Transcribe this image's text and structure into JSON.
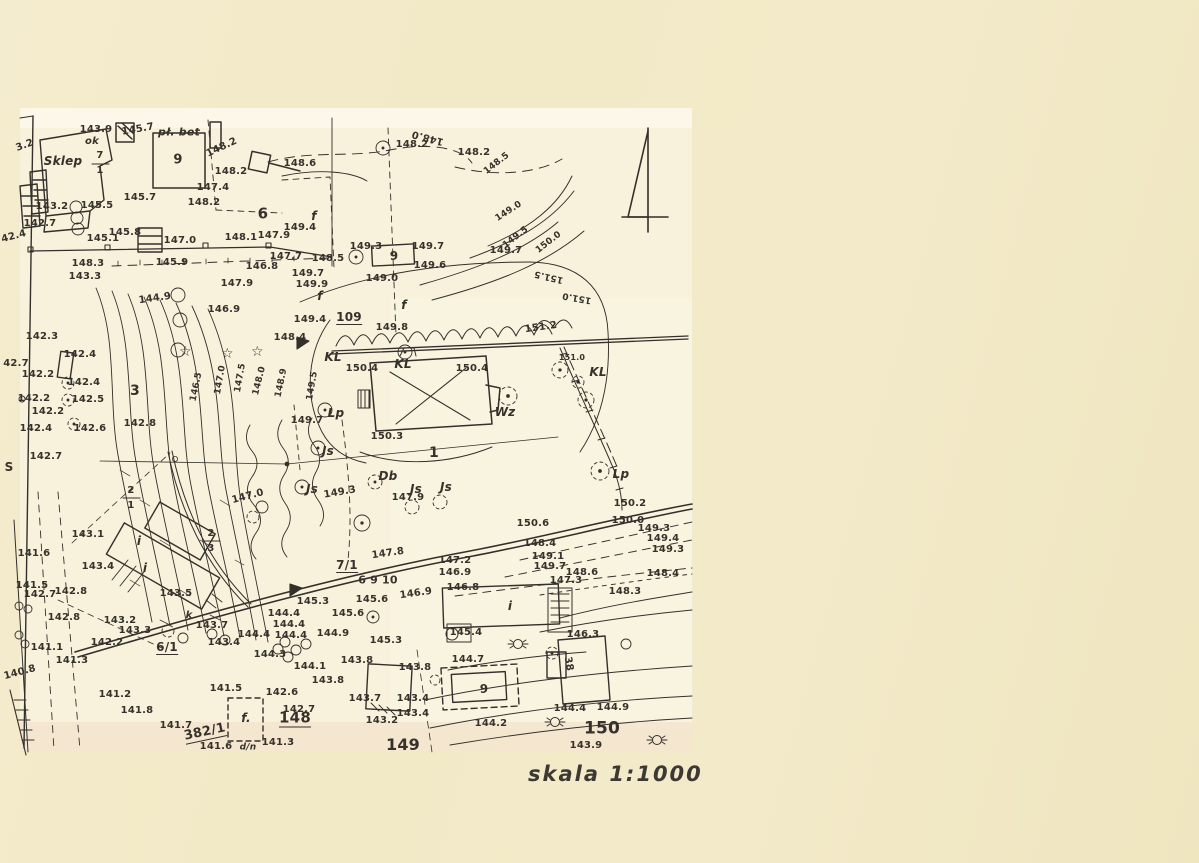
{
  "colors": {
    "paper": "#f1e8c6",
    "sheet": "#f8f1dc",
    "ink": "#33302b"
  },
  "map": {
    "scale_label": "skala 1:1000",
    "north_arrow": "north-arrow",
    "labels": [
      {
        "t": "143.9",
        "x": 96,
        "y": 130
      },
      {
        "t": "ok",
        "x": 92,
        "y": 142,
        "n": "abbrev-label",
        "i": 1
      },
      {
        "t": "pł. bet",
        "x": 179,
        "y": 132,
        "s": 11,
        "n": "surface-label",
        "i": 1
      },
      {
        "t": "Sklep",
        "x": 63,
        "y": 161,
        "s": 12,
        "n": "building-name-label",
        "i": 1
      },
      {
        "t": "7",
        "x": 100,
        "y": 156,
        "n": "parcel-label"
      },
      {
        "t": "1",
        "x": 100,
        "y": 171,
        "n": "parcel-label"
      },
      {
        "t": "9",
        "x": 178,
        "y": 160,
        "s": 13,
        "n": "building-label"
      },
      {
        "t": "3.2",
        "x": 25,
        "y": 146,
        "r": -20
      },
      {
        "t": "145.7",
        "x": 138,
        "y": 130,
        "r": -10
      },
      {
        "t": "148.2",
        "x": 222,
        "y": 148,
        "r": -25
      },
      {
        "t": "148.2",
        "x": 231,
        "y": 172
      },
      {
        "t": "147.4",
        "x": 213,
        "y": 188
      },
      {
        "t": "148.2",
        "x": 204,
        "y": 203
      },
      {
        "t": "6",
        "x": 263,
        "y": 214,
        "s": 15,
        "n": "parcel-label"
      },
      {
        "t": "145.5",
        "x": 97,
        "y": 206
      },
      {
        "t": "145.7",
        "x": 140,
        "y": 198
      },
      {
        "t": "143.2",
        "x": 52,
        "y": 207
      },
      {
        "t": "142.7",
        "x": 40,
        "y": 224
      },
      {
        "t": "145.1",
        "x": 103,
        "y": 239
      },
      {
        "t": "145.8",
        "x": 125,
        "y": 233
      },
      {
        "t": "147.0",
        "x": 180,
        "y": 241
      },
      {
        "t": "148.1",
        "x": 241,
        "y": 238
      },
      {
        "t": "145.9",
        "x": 172,
        "y": 263
      },
      {
        "t": "148.3",
        "x": 88,
        "y": 264
      },
      {
        "t": "143.3",
        "x": 85,
        "y": 277
      },
      {
        "t": "144.9",
        "x": 155,
        "y": 299,
        "r": -8
      },
      {
        "t": "147.9",
        "x": 274,
        "y": 236
      },
      {
        "t": "147.9",
        "x": 237,
        "y": 284
      },
      {
        "t": "146.9",
        "x": 224,
        "y": 310
      },
      {
        "t": "147.7",
        "x": 286,
        "y": 257
      },
      {
        "t": "146.8",
        "x": 262,
        "y": 267
      },
      {
        "t": "148.5",
        "x": 328,
        "y": 259
      },
      {
        "t": "149.4",
        "x": 300,
        "y": 228
      },
      {
        "t": "149.3",
        "x": 366,
        "y": 247
      },
      {
        "t": "9",
        "x": 394,
        "y": 256,
        "s": 12,
        "n": "building-label"
      },
      {
        "t": "149.7",
        "x": 428,
        "y": 247
      },
      {
        "t": "149.6",
        "x": 430,
        "y": 266
      },
      {
        "t": "149.0",
        "x": 382,
        "y": 279
      },
      {
        "t": "149.7",
        "x": 308,
        "y": 274
      },
      {
        "t": "149.9",
        "x": 312,
        "y": 285
      },
      {
        "t": "f",
        "x": 314,
        "y": 216,
        "s": 12,
        "i": 1,
        "n": "tree-species-label"
      },
      {
        "t": "f",
        "x": 320,
        "y": 296,
        "s": 12,
        "i": 1,
        "n": "tree-species-label"
      },
      {
        "t": "f",
        "x": 404,
        "y": 305,
        "s": 12,
        "i": 1,
        "n": "tree-species-label"
      },
      {
        "t": "149.4",
        "x": 310,
        "y": 320
      },
      {
        "t": "109",
        "x": 349,
        "y": 318,
        "s": 12,
        "u": 1,
        "n": "parcel-label"
      },
      {
        "t": "149.8",
        "x": 392,
        "y": 328
      },
      {
        "t": "148.4",
        "x": 290,
        "y": 338
      },
      {
        "t": "148.6",
        "x": 300,
        "y": 164
      },
      {
        "t": "148.0",
        "x": 428,
        "y": 137,
        "r": 195
      },
      {
        "t": "148.2",
        "x": 412,
        "y": 145
      },
      {
        "t": "148.2",
        "x": 474,
        "y": 153
      },
      {
        "t": "148.5",
        "x": 497,
        "y": 164,
        "r": -38,
        "s": 9
      },
      {
        "t": "149.0",
        "x": 509,
        "y": 212,
        "r": -33,
        "s": 9
      },
      {
        "t": "149.5",
        "x": 516,
        "y": 238,
        "r": -38,
        "s": 9
      },
      {
        "t": "150.0",
        "x": 549,
        "y": 243,
        "r": -38,
        "s": 9
      },
      {
        "t": "149.7",
        "x": 506,
        "y": 251
      },
      {
        "t": "151.5",
        "x": 549,
        "y": 276,
        "r": 193,
        "s": 9
      },
      {
        "t": "151.0",
        "x": 577,
        "y": 297,
        "r": 190,
        "s": 9
      },
      {
        "t": "151.2",
        "x": 541,
        "y": 328,
        "r": -8
      },
      {
        "t": "151.0",
        "x": 572,
        "y": 358,
        "s": 8
      },
      {
        "t": "KL",
        "x": 333,
        "y": 357,
        "s": 12,
        "i": 1,
        "n": "tree-species-label"
      },
      {
        "t": "KL",
        "x": 403,
        "y": 364,
        "s": 12,
        "i": 1,
        "n": "tree-species-label"
      },
      {
        "t": "KL",
        "x": 598,
        "y": 372,
        "s": 12,
        "i": 1,
        "n": "tree-species-label"
      },
      {
        "t": "150.4",
        "x": 362,
        "y": 369
      },
      {
        "t": "150.4",
        "x": 472,
        "y": 369
      },
      {
        "t": "Wz",
        "x": 505,
        "y": 412,
        "s": 12,
        "i": 1,
        "n": "tree-species-label"
      },
      {
        "t": "150.3",
        "x": 387,
        "y": 437
      },
      {
        "t": "1",
        "x": 434,
        "y": 453,
        "s": 14,
        "n": "building-label"
      },
      {
        "t": "Lp",
        "x": 621,
        "y": 474,
        "s": 12,
        "i": 1,
        "n": "tree-species-label"
      },
      {
        "t": "Lp",
        "x": 336,
        "y": 413,
        "s": 12,
        "i": 1,
        "n": "tree-species-label"
      },
      {
        "t": "149.7",
        "x": 307,
        "y": 421
      },
      {
        "t": "150.2",
        "x": 630,
        "y": 504
      },
      {
        "t": "150.0",
        "x": 628,
        "y": 521
      },
      {
        "t": "150.6",
        "x": 533,
        "y": 524
      },
      {
        "t": "149.3",
        "x": 654,
        "y": 529
      },
      {
        "t": "149.4",
        "x": 663,
        "y": 539
      },
      {
        "t": "149.3",
        "x": 668,
        "y": 550
      },
      {
        "t": "148.4",
        "x": 540,
        "y": 544
      },
      {
        "t": "149.1",
        "x": 548,
        "y": 557
      },
      {
        "t": "149.7",
        "x": 550,
        "y": 567
      },
      {
        "t": "148.6",
        "x": 582,
        "y": 573
      },
      {
        "t": "148.4",
        "x": 663,
        "y": 574
      },
      {
        "t": "147.3",
        "x": 566,
        "y": 581
      },
      {
        "t": "148.3",
        "x": 625,
        "y": 592
      },
      {
        "t": "146.3",
        "x": 583,
        "y": 635
      },
      {
        "t": "38",
        "x": 568,
        "y": 664,
        "r": 80,
        "n": "building-label"
      },
      {
        "t": "i",
        "x": 510,
        "y": 606,
        "s": 12,
        "i": 1,
        "n": "building-label"
      },
      {
        "t": "145.4",
        "x": 466,
        "y": 633
      },
      {
        "t": "144.7",
        "x": 468,
        "y": 660
      },
      {
        "t": "9",
        "x": 484,
        "y": 689,
        "s": 12,
        "n": "building-label"
      },
      {
        "t": "144.4",
        "x": 570,
        "y": 709
      },
      {
        "t": "144.9",
        "x": 613,
        "y": 708
      },
      {
        "t": "144.2",
        "x": 491,
        "y": 724
      },
      {
        "t": "150",
        "x": 602,
        "y": 729,
        "s": 17
      },
      {
        "t": "143.9",
        "x": 586,
        "y": 746
      },
      {
        "t": "142.3",
        "x": 42,
        "y": 337
      },
      {
        "t": "142.4",
        "x": 80,
        "y": 355
      },
      {
        "t": "42.7",
        "x": 16,
        "y": 364
      },
      {
        "t": "142.2",
        "x": 38,
        "y": 375
      },
      {
        "t": "142.4",
        "x": 84,
        "y": 383
      },
      {
        "t": "142.2",
        "x": 34,
        "y": 399
      },
      {
        "t": "142.5",
        "x": 88,
        "y": 400
      },
      {
        "t": "3",
        "x": 135,
        "y": 391,
        "s": 14,
        "n": "parcel-label"
      },
      {
        "t": "142.2",
        "x": 48,
        "y": 412
      },
      {
        "t": "142.8",
        "x": 140,
        "y": 424
      },
      {
        "t": "142.4",
        "x": 36,
        "y": 429
      },
      {
        "t": "142.6",
        "x": 90,
        "y": 429
      },
      {
        "t": "142.7",
        "x": 46,
        "y": 457
      },
      {
        "t": "42.4",
        "x": 14,
        "y": 237,
        "r": -15
      },
      {
        "t": "146.5",
        "x": 197,
        "y": 387,
        "r": -78,
        "s": 9
      },
      {
        "t": "147.0",
        "x": 221,
        "y": 380,
        "r": -80,
        "s": 9
      },
      {
        "t": "147.5",
        "x": 241,
        "y": 378,
        "r": -80,
        "s": 9
      },
      {
        "t": "148.0",
        "x": 260,
        "y": 381,
        "r": -76,
        "s": 9
      },
      {
        "t": "148.9",
        "x": 282,
        "y": 383,
        "r": -78,
        "s": 9
      },
      {
        "t": "149.5",
        "x": 313,
        "y": 386,
        "r": -80,
        "s": 9
      },
      {
        "t": "S",
        "x": 9,
        "y": 467,
        "s": 12,
        "n": "boundary-letter-label"
      },
      {
        "t": "2",
        "x": 131,
        "y": 491,
        "n": "parcel-label"
      },
      {
        "t": "1",
        "x": 131,
        "y": 506,
        "n": "parcel-label"
      },
      {
        "t": "2",
        "x": 211,
        "y": 534,
        "n": "parcel-label"
      },
      {
        "t": "3",
        "x": 211,
        "y": 549,
        "n": "parcel-label"
      },
      {
        "t": "147.0",
        "x": 248,
        "y": 497,
        "r": -15
      },
      {
        "t": "149.3",
        "x": 340,
        "y": 493,
        "r": -10
      },
      {
        "t": "147.9",
        "x": 408,
        "y": 498
      },
      {
        "t": "Js",
        "x": 312,
        "y": 489,
        "s": 12,
        "i": 1,
        "n": "tree-species-label"
      },
      {
        "t": "Js",
        "x": 328,
        "y": 451,
        "s": 12,
        "i": 1,
        "n": "tree-species-label"
      },
      {
        "t": "Db",
        "x": 388,
        "y": 476,
        "s": 12,
        "i": 1,
        "n": "tree-species-label"
      },
      {
        "t": "Js",
        "x": 416,
        "y": 489,
        "s": 12,
        "i": 1,
        "n": "tree-species-label"
      },
      {
        "t": "Js",
        "x": 446,
        "y": 487,
        "s": 12,
        "i": 1,
        "n": "tree-species-label"
      },
      {
        "t": "143.1",
        "x": 88,
        "y": 535
      },
      {
        "t": "143.4",
        "x": 98,
        "y": 567
      },
      {
        "t": "i",
        "x": 139,
        "y": 541,
        "s": 12,
        "i": 1,
        "n": "building-label"
      },
      {
        "t": "i",
        "x": 145,
        "y": 568,
        "s": 12,
        "i": 1,
        "n": "building-label"
      },
      {
        "t": "142.7",
        "x": 40,
        "y": 595
      },
      {
        "t": "142.8",
        "x": 71,
        "y": 592
      },
      {
        "t": "141.6",
        "x": 34,
        "y": 554
      },
      {
        "t": "141.5",
        "x": 32,
        "y": 586
      },
      {
        "t": "142.8",
        "x": 64,
        "y": 618
      },
      {
        "t": "143.5",
        "x": 176,
        "y": 594
      },
      {
        "t": "143.2",
        "x": 120,
        "y": 621
      },
      {
        "t": "143.3",
        "x": 135,
        "y": 631
      },
      {
        "t": "142.2",
        "x": 107,
        "y": 643
      },
      {
        "t": "6/1",
        "x": 167,
        "y": 648,
        "s": 12,
        "u": 1,
        "n": "parcel-label"
      },
      {
        "t": "k",
        "x": 189,
        "y": 616,
        "i": 1,
        "n": "abbrev-label"
      },
      {
        "t": "143.7",
        "x": 212,
        "y": 626
      },
      {
        "t": "143.4",
        "x": 224,
        "y": 643
      },
      {
        "t": "143.8",
        "x": 415,
        "y": 668
      },
      {
        "t": "143.4",
        "x": 413,
        "y": 699
      },
      {
        "t": "143.4",
        "x": 413,
        "y": 714
      },
      {
        "t": "144.4",
        "x": 284,
        "y": 614
      },
      {
        "t": "144.4",
        "x": 289,
        "y": 625
      },
      {
        "t": "144.4",
        "x": 254,
        "y": 635
      },
      {
        "t": "144.4",
        "x": 291,
        "y": 636
      },
      {
        "t": "144.9",
        "x": 333,
        "y": 634
      },
      {
        "t": "145.6",
        "x": 348,
        "y": 614
      },
      {
        "t": "145.3",
        "x": 313,
        "y": 602
      },
      {
        "t": "145.3",
        "x": 386,
        "y": 641
      },
      {
        "t": "145.6",
        "x": 372,
        "y": 600
      },
      {
        "t": "144.3",
        "x": 270,
        "y": 655
      },
      {
        "t": "144.1",
        "x": 310,
        "y": 667
      },
      {
        "t": "143.8",
        "x": 357,
        "y": 661
      },
      {
        "t": "143.8",
        "x": 328,
        "y": 681
      },
      {
        "t": "142.6",
        "x": 282,
        "y": 693
      },
      {
        "t": "143.7",
        "x": 365,
        "y": 699
      },
      {
        "t": "142.7",
        "x": 299,
        "y": 710
      },
      {
        "t": "148",
        "x": 295,
        "y": 719,
        "s": 15,
        "u": 1
      },
      {
        "t": "143.2",
        "x": 382,
        "y": 721
      },
      {
        "t": "f.",
        "x": 246,
        "y": 718,
        "s": 12,
        "i": 1,
        "n": "tree-species-label"
      },
      {
        "t": "141.5",
        "x": 226,
        "y": 689
      },
      {
        "t": "141.2",
        "x": 115,
        "y": 695
      },
      {
        "t": "141.8",
        "x": 137,
        "y": 711
      },
      {
        "t": "141.7",
        "x": 176,
        "y": 726
      },
      {
        "t": "382/1",
        "x": 205,
        "y": 733,
        "s": 13,
        "u": 1,
        "r": -12,
        "n": "parcel-label"
      },
      {
        "t": "141.6",
        "x": 216,
        "y": 747
      },
      {
        "t": "d/n",
        "x": 248,
        "y": 748,
        "s": 9,
        "i": 1,
        "n": "abbrev-label"
      },
      {
        "t": "141.3",
        "x": 278,
        "y": 743
      },
      {
        "t": "149",
        "x": 403,
        "y": 745,
        "s": 16
      },
      {
        "t": "140.8",
        "x": 20,
        "y": 673,
        "r": -15
      },
      {
        "t": "141.1",
        "x": 47,
        "y": 648
      },
      {
        "t": "141.3",
        "x": 72,
        "y": 661
      },
      {
        "t": "7/1",
        "x": 347,
        "y": 566,
        "s": 12,
        "u": 1,
        "n": "parcel-label"
      },
      {
        "t": "147.8",
        "x": 388,
        "y": 554,
        "r": -8
      },
      {
        "t": "147.2",
        "x": 455,
        "y": 561
      },
      {
        "t": "146.9",
        "x": 455,
        "y": 573
      },
      {
        "t": "146.8",
        "x": 463,
        "y": 588
      },
      {
        "t": "146.9",
        "x": 416,
        "y": 594,
        "r": -8
      },
      {
        "t": "6 9 10",
        "x": 378,
        "y": 580,
        "s": 11,
        "n": "tree-number-label"
      }
    ]
  }
}
